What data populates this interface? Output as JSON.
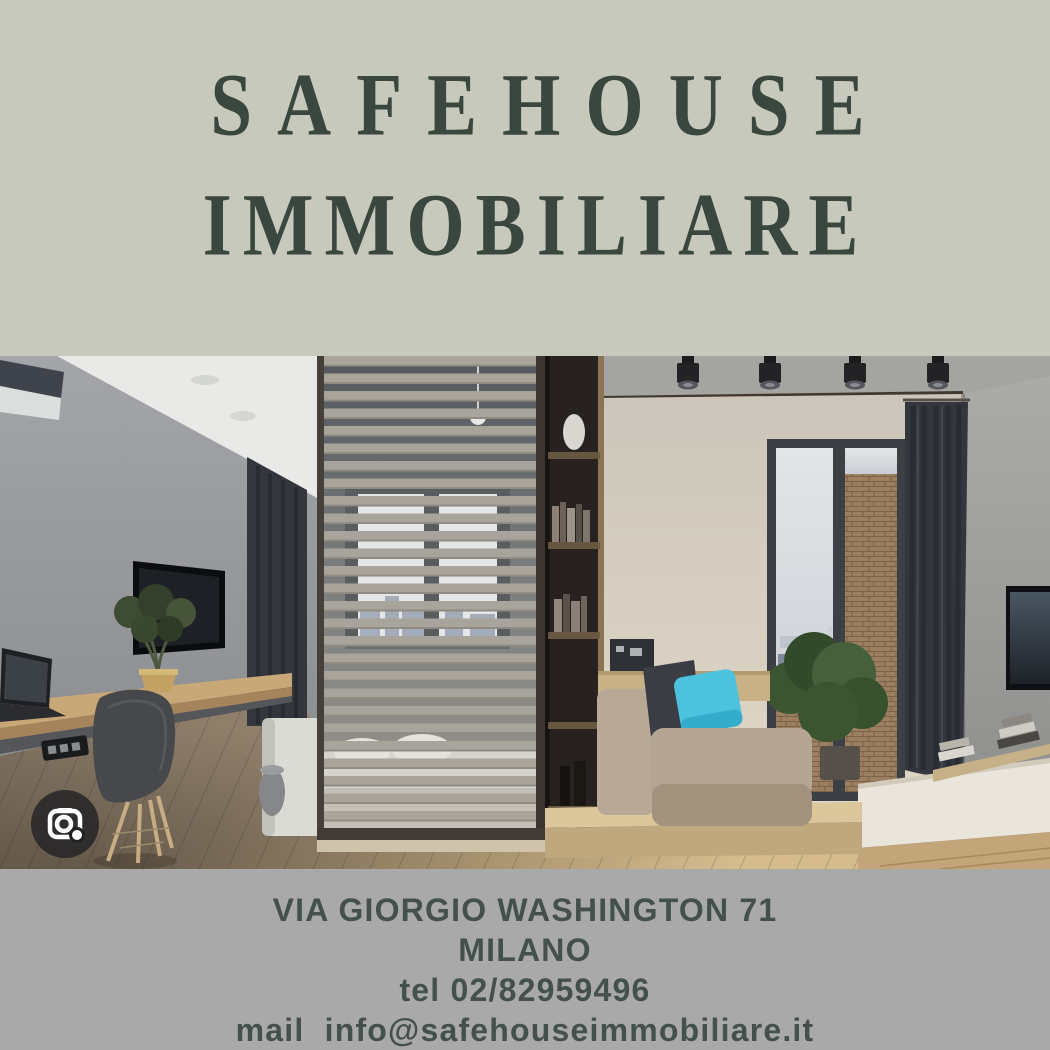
{
  "colors": {
    "top_band_bg": "#c8c9bd",
    "bottom_band_bg": "#a9a9a9",
    "title_green": "#3a473f",
    "footer_green": "#44514b",
    "lens_circle": "rgba(32,33,36,0.8)",
    "pillow_cyan": "#4cc2de"
  },
  "header": {
    "title_line1": "SAFEHOUSE",
    "title_line2": "IMMOBILIARE"
  },
  "photo": {
    "description": "modern studio apartment interior: gray wall with TV and floating desk, slatted wood room divider with bed behind, dark bookshelf, beige daybed with cyan pillow, balcony glass door with city view, dark curtains, concrete wall",
    "overlay_icon": "google-lens-camera-icon"
  },
  "footer": {
    "address_line": "VIA GIORGIO WASHINGTON 71",
    "city_line": "MILANO",
    "phone_line": "tel 02/82959496",
    "email_line": "mail  info@safehouseimmobiliare.it"
  }
}
